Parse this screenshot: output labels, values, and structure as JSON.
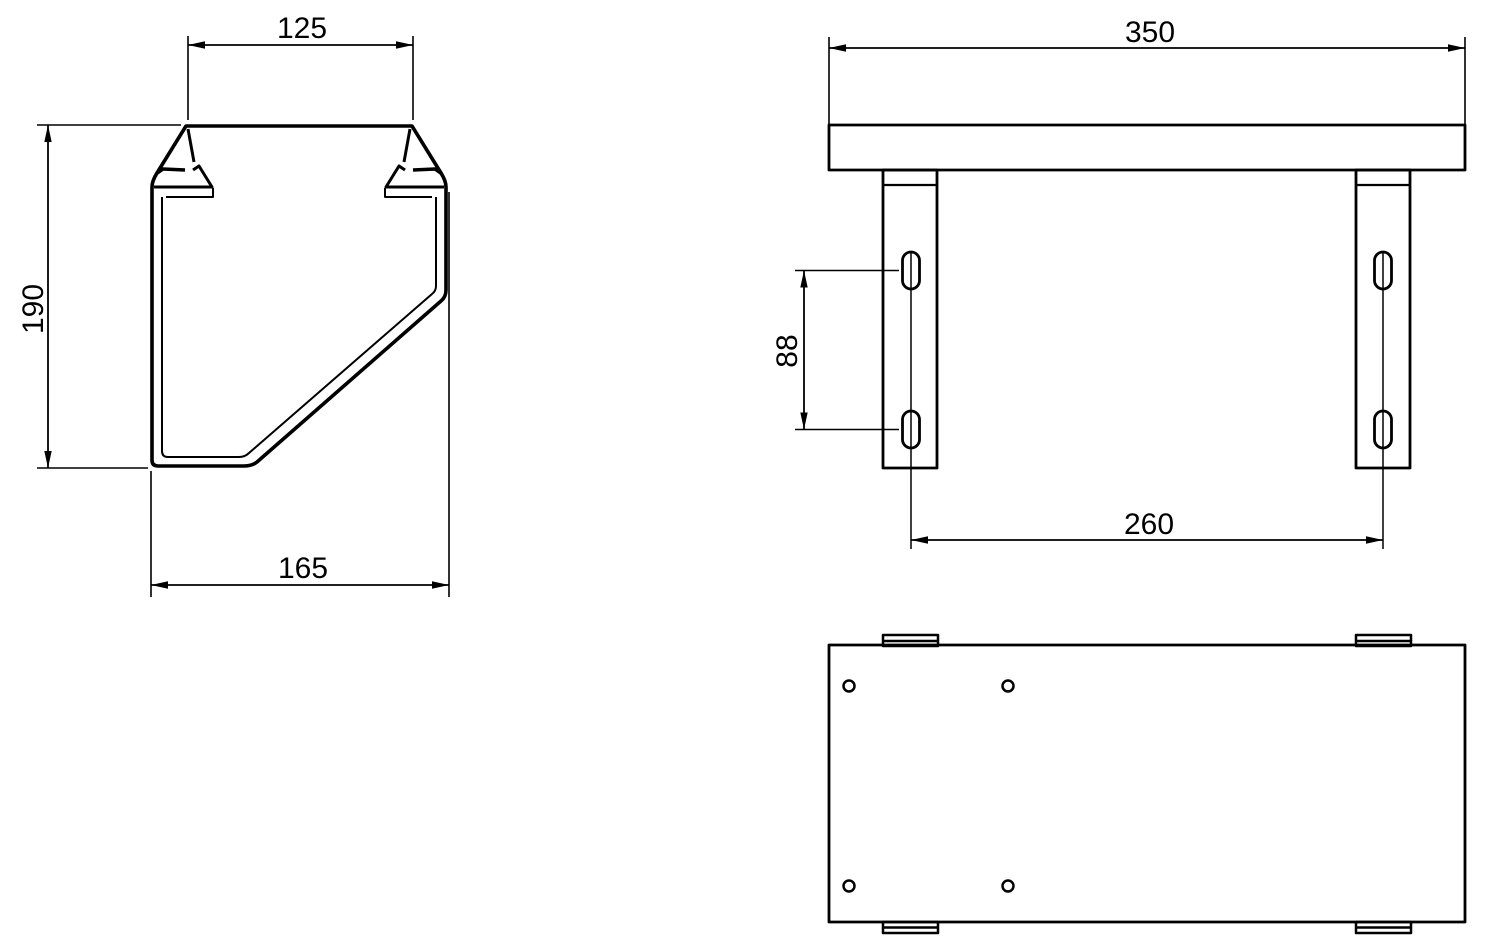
{
  "drawing": {
    "kind": "technical-orthographic-drawing",
    "background_color": "#ffffff",
    "line_color": "#000000",
    "views": {
      "side_profile": {
        "dimensions": {
          "top_width": "125",
          "height": "190",
          "bottom_width": "165"
        }
      },
      "front": {
        "dimensions": {
          "overall_width": "350",
          "slot_spacing": "88",
          "bracket_spacing": "260"
        },
        "slot_count": 4,
        "bracket_count": 2
      },
      "top_plan": {
        "hole_count": 4,
        "tab_count": 4
      }
    }
  }
}
